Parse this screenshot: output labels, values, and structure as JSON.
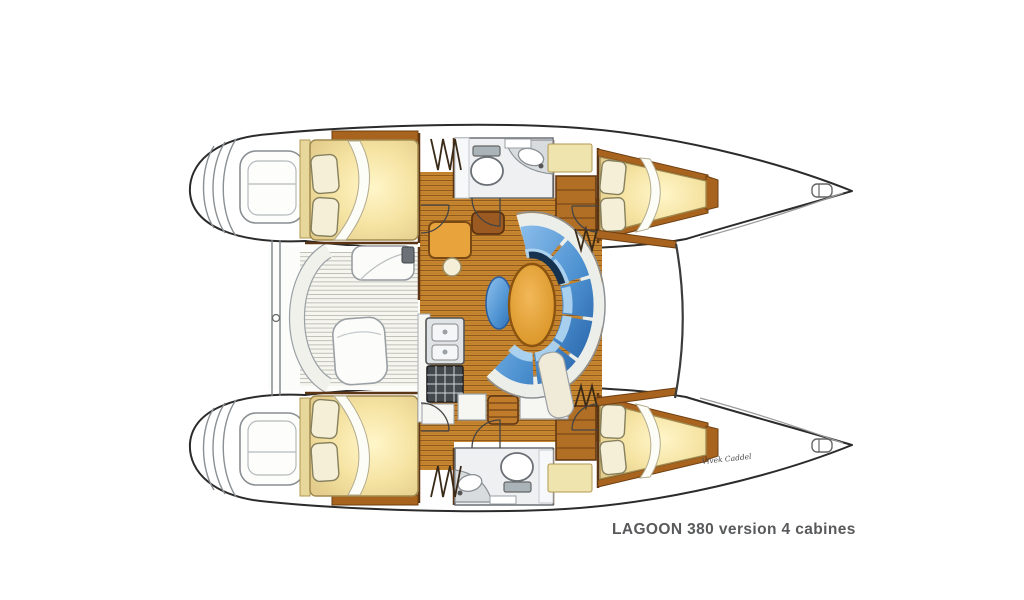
{
  "page": {
    "background": "#ffffff"
  },
  "caption": {
    "text": "LAGOON 380 version 4 cabines",
    "color": "#58595b"
  },
  "signature": {
    "text": "Vivek Caddel"
  },
  "diagram": {
    "type": "yacht-floor-plan",
    "vessel": "Lagoon 380 catamaran",
    "layout_version": "4 cabins",
    "view": "top-down deck plan, bows to the right, twin hulls joined by central saloon",
    "features": [
      "port aft double cabin with pillows and duvet",
      "port forward double cabin with pillows and duvet",
      "starboard aft double cabin with pillows and duvet",
      "starboard forward double cabin with pillows and duvet",
      "two heads with toilet and washbasin",
      "saloon with oval dining table, curved blue settee and bench stool",
      "chart table with round stool",
      "galley with twin sinks and stove",
      "aft cockpit with curved bench, helm seat and cockpit table",
      "twin transom swim steps",
      "companionway stairs shown as hatched zigzags"
    ],
    "colors": {
      "outline": "#2b2b2b",
      "wood_floor": "#c8862f",
      "wood_trim": "#8a4f16",
      "bedding": "#f2e2a0",
      "pillow": "#f5efd8",
      "upholstery": "#4f93d2",
      "upholstery_dark": "#16324f",
      "table": "#e8a33d",
      "fixture_grey": "#d8dcdf",
      "caption": "#58595b"
    }
  }
}
